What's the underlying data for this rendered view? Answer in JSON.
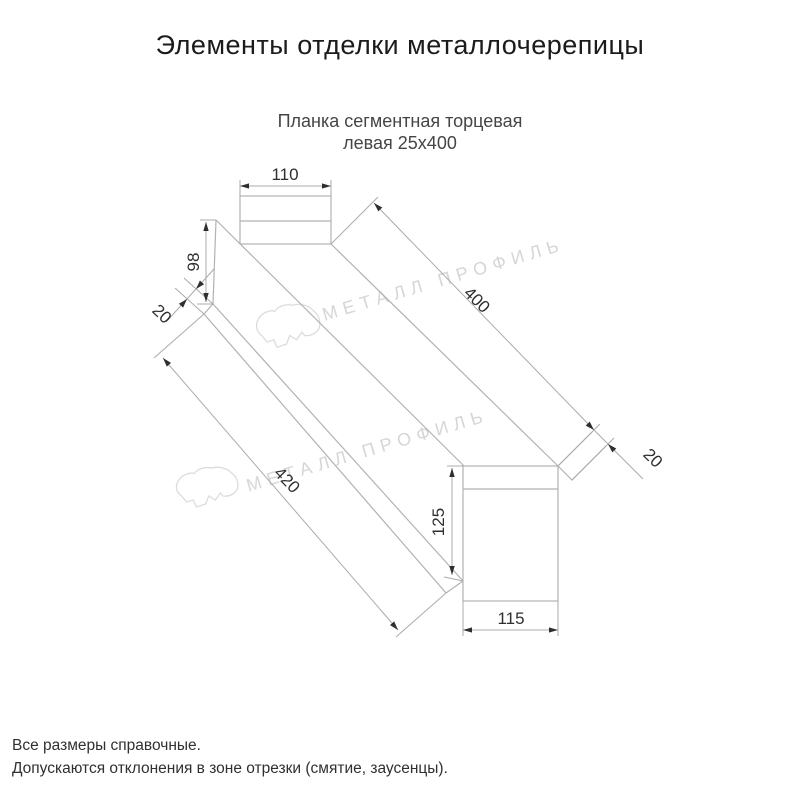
{
  "page": {
    "title": "Элементы отделки металлочерепицы",
    "subtitle_line1": "Планка сегментная торцевая",
    "subtitle_line2": "левая 25х400"
  },
  "drawing": {
    "dim_top_flange_width": "110",
    "dim_left_face_height": "98",
    "dim_left_fold": "20",
    "dim_top_length": "400",
    "dim_right_fold": "20",
    "dim_bottom_length": "420",
    "dim_right_face_height": "125",
    "dim_right_face_width": "115"
  },
  "watermark": {
    "text": "МЕТАЛЛ ПРОФИЛЬ",
    "logo": "cloud-logo"
  },
  "footer": {
    "line1": "Все размеры справочные.",
    "line2": "Допускаются отклонения в зоне отрезки (смятие, заусенцы)."
  },
  "colors": {
    "part_line": "#b2b2b2",
    "dim_line": "#ababab",
    "dim_text": "#2f2f2f",
    "watermark": "#d6d6d6",
    "title_text": "#1b1b1b"
  }
}
